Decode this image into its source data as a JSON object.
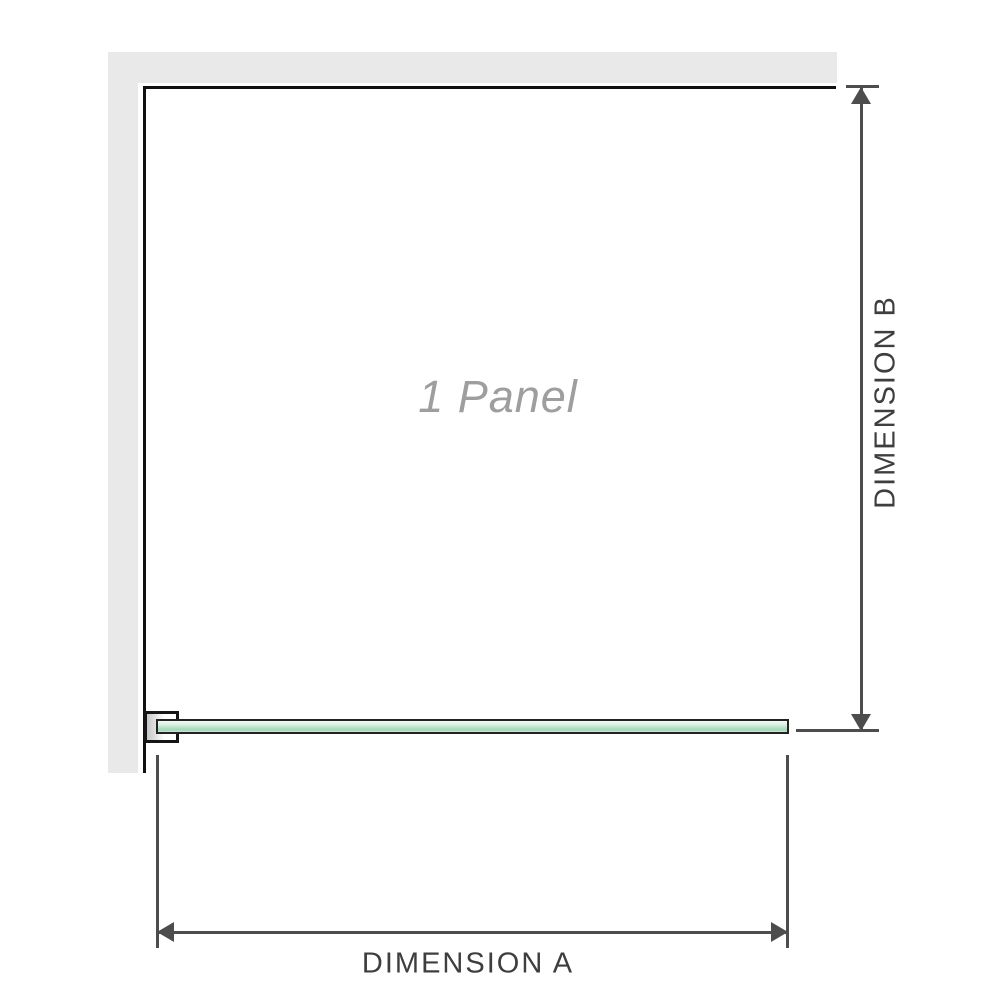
{
  "diagram": {
    "panel_label": "1 Panel",
    "dimension_a_label": "DIMENSION A",
    "dimension_b_label": "DIMENSION B"
  },
  "icons": {
    "dimension_b_arrows": "double-headed-vertical-arrow",
    "dimension_a_arrows": "double-headed-horizontal-arrow"
  },
  "colors": {
    "wall_fill": "#e9e9e9",
    "panel_border": "#111111",
    "glass_fill": "#b2dec2",
    "glass_border": "#222222",
    "dimension_line": "#4d4d4d",
    "dimension_text": "#3e3e3e",
    "panel_label_text": "#9e9e9e"
  }
}
